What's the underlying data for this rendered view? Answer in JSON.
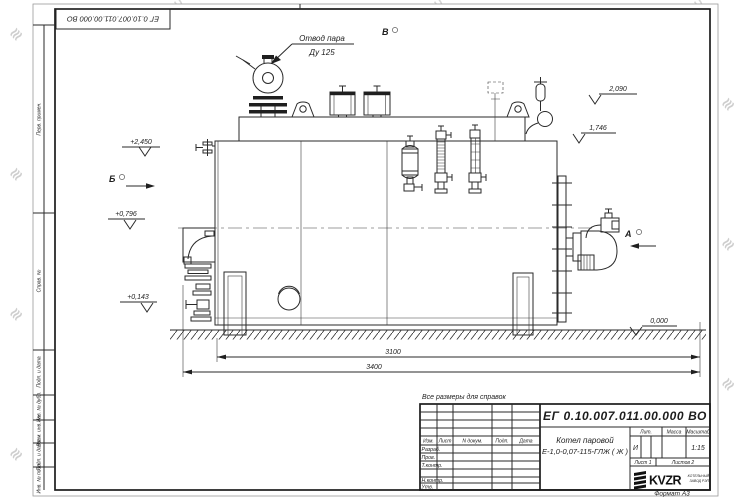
{
  "sheet": {
    "stamp_doc_number": "ЕГ 0.10.007.011.00.000  ВО",
    "note": "Все размеры для справок",
    "format_label": "Формат А3",
    "watermark_text": "KVZR.RU",
    "watermark_color": "#c7c7c7"
  },
  "margin_labels": [
    "Перв. примен.",
    "Справ. №",
    "Подп. и дата",
    "Инв. № дубл.",
    "Взам. инв. №",
    "Подп. и дата",
    "Инв. № подл."
  ],
  "title_block": {
    "doc_number": "ЕГ 0.10.007.011.00.000  ВО",
    "product_line1": "Котел паровой",
    "product_line2": "Е-1,0-0,07-115-ГЛЖ ( Ж )",
    "col_izm": "Изм.",
    "col_list": "Лист",
    "col_ndoc": "N докум.",
    "col_podp": "Подп.",
    "col_data": "Дата",
    "row_razrab": "Разраб.",
    "row_prov": "Пров.",
    "row_tkontr": "Т.контр.",
    "row_nkontr": "Н.контр.",
    "row_utv": "Утв.",
    "lit_label": "Лит.",
    "mass_label": "Масса",
    "scale_label": "Масштаб",
    "lit_value": "И",
    "scale_value": "1:15",
    "list_label": "Лист 1",
    "listov_label": "Листов 2",
    "logo_text": "KVZR",
    "logo_sub1": "КОТЕЛЬНЫЙ",
    "logo_sub2": "ЗАВОД РЭП"
  },
  "annotations": {
    "steam_line1": "Отвод пара",
    "steam_line2": "Ду 125",
    "view_a": "А",
    "view_b": "Б",
    "view_v": "В",
    "elev_plus2450": "+2,450",
    "elev_2090": "2,090",
    "elev_1746": "1,746",
    "elev_plus0796": "+0,796",
    "elev_plus0143": "+0,143",
    "elev_0000": "0,000",
    "dim_body": "3100",
    "dim_overall": "3400"
  }
}
